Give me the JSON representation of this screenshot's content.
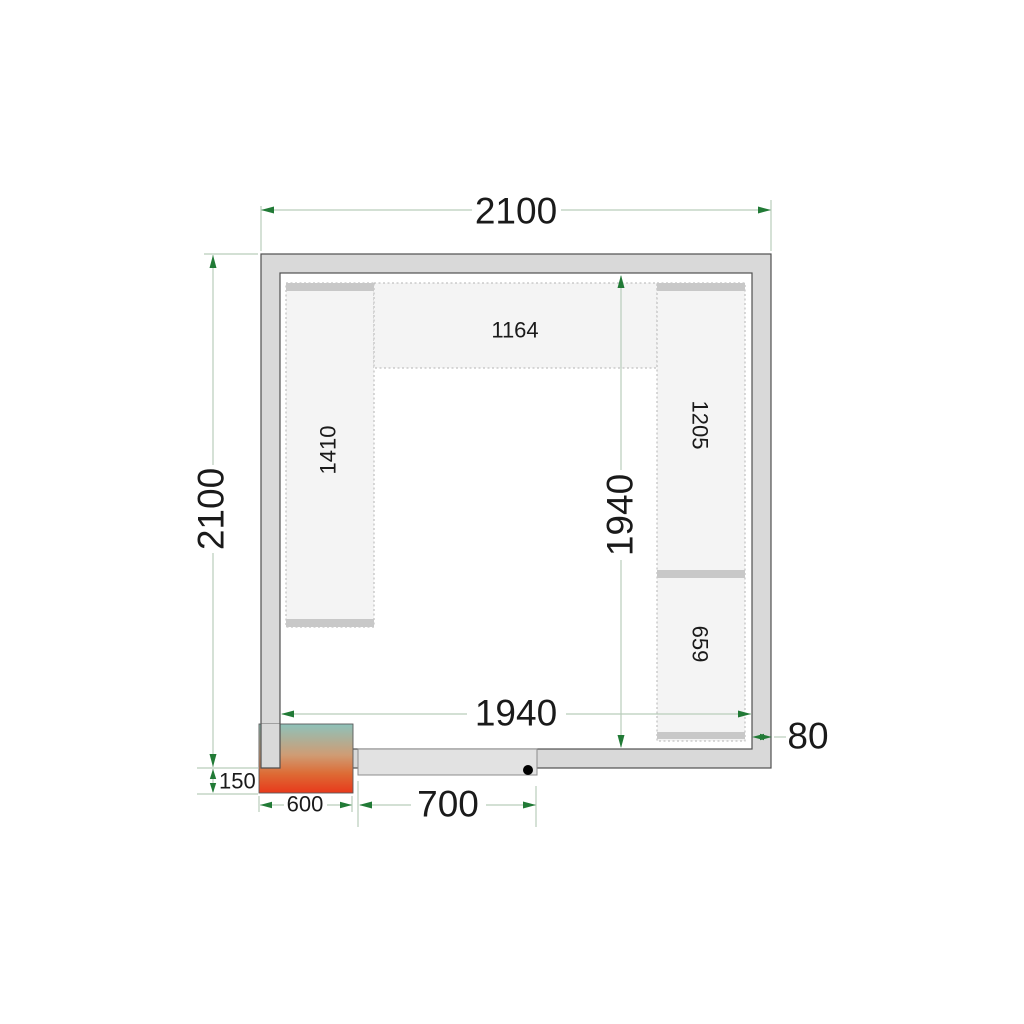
{
  "diagram_title": "Cold room floor plan (top view)",
  "dimensions": {
    "outer_width": "2100",
    "outer_depth": "2100",
    "inner_width": "1940",
    "inner_depth": "1940",
    "wall_thickness": "80",
    "unit_protrusion": "150",
    "unit_width": "600",
    "door_width": "700"
  },
  "shelves": {
    "top": "1164",
    "left": "1410",
    "right_upper": "1205",
    "right_lower": "659"
  },
  "colors": {
    "wall_fill": "#d9d9d9",
    "wall_outline": "#4f4f4f",
    "shelf_fill": "#f4f4f4",
    "shelf_border": "#b3b3b3",
    "shelf_support": "#c8c8c8",
    "door_fill": "#e2e2e2",
    "dimension_line": "#b9cdbb",
    "dimension_arrow": "#217a36",
    "dimension_text": "#1a1a1a",
    "unit_gradient_top": "#8ec2ba",
    "unit_gradient_mid": "#cf9c74",
    "unit_gradient_warm": "#dd6b35",
    "unit_gradient_bottom": "#e8391b",
    "hinge_dot": "#000000"
  }
}
